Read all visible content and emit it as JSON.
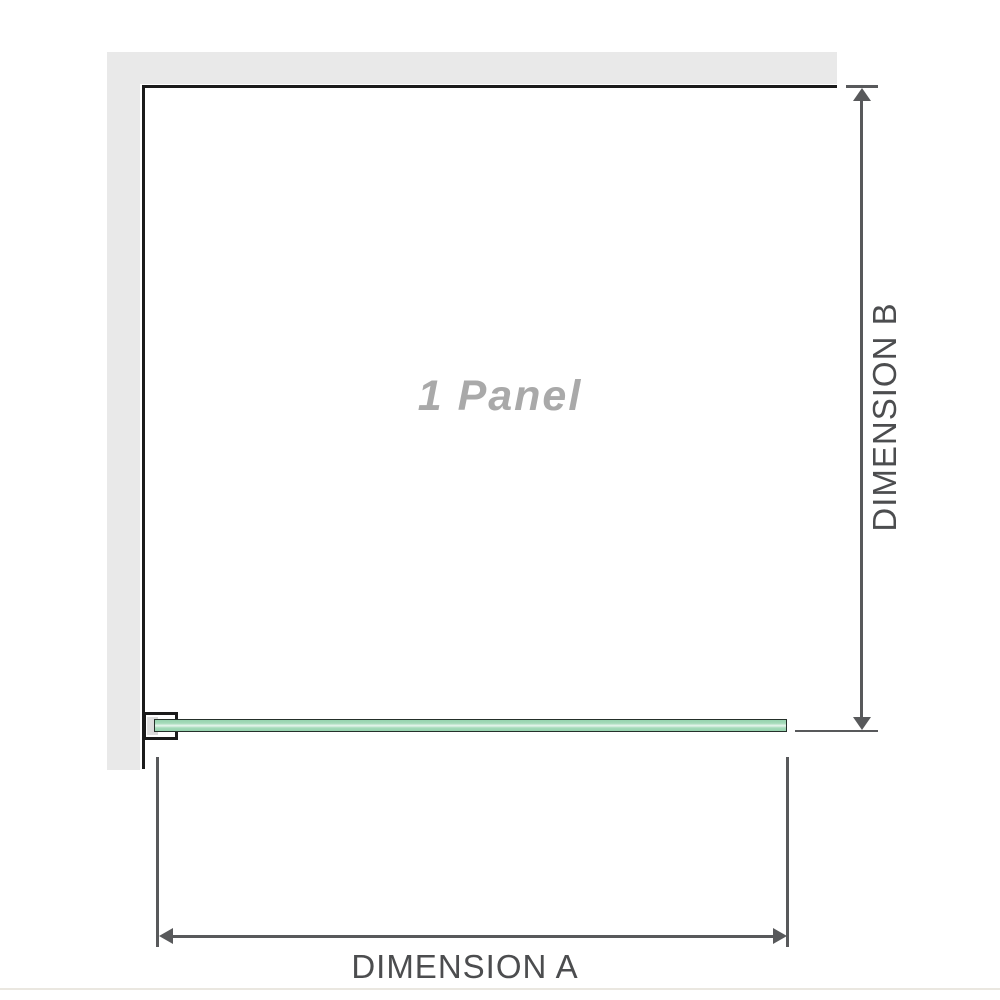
{
  "diagram": {
    "panel_label": "1 Panel",
    "dimension_a_label": "DIMENSION A",
    "dimension_b_label": "DIMENSION B"
  },
  "colors": {
    "wall": "#e9e9e9",
    "panel_outline": "#1b1b1b",
    "dimension_line": "#58595b",
    "dimension_text": "#4c4d4f",
    "panel_label_text": "#a9a9a9",
    "glass_border": "#25302a",
    "glass_green": "#a5dbba",
    "glass_green_deep": "#96d3ae",
    "glass_highlight": "#e7f6ed",
    "bracket_fill": "#ffffff",
    "bracket_pad": "#d7d7d7",
    "page_divider": "#eae7e0",
    "canvas_bg": "#ffffff"
  }
}
